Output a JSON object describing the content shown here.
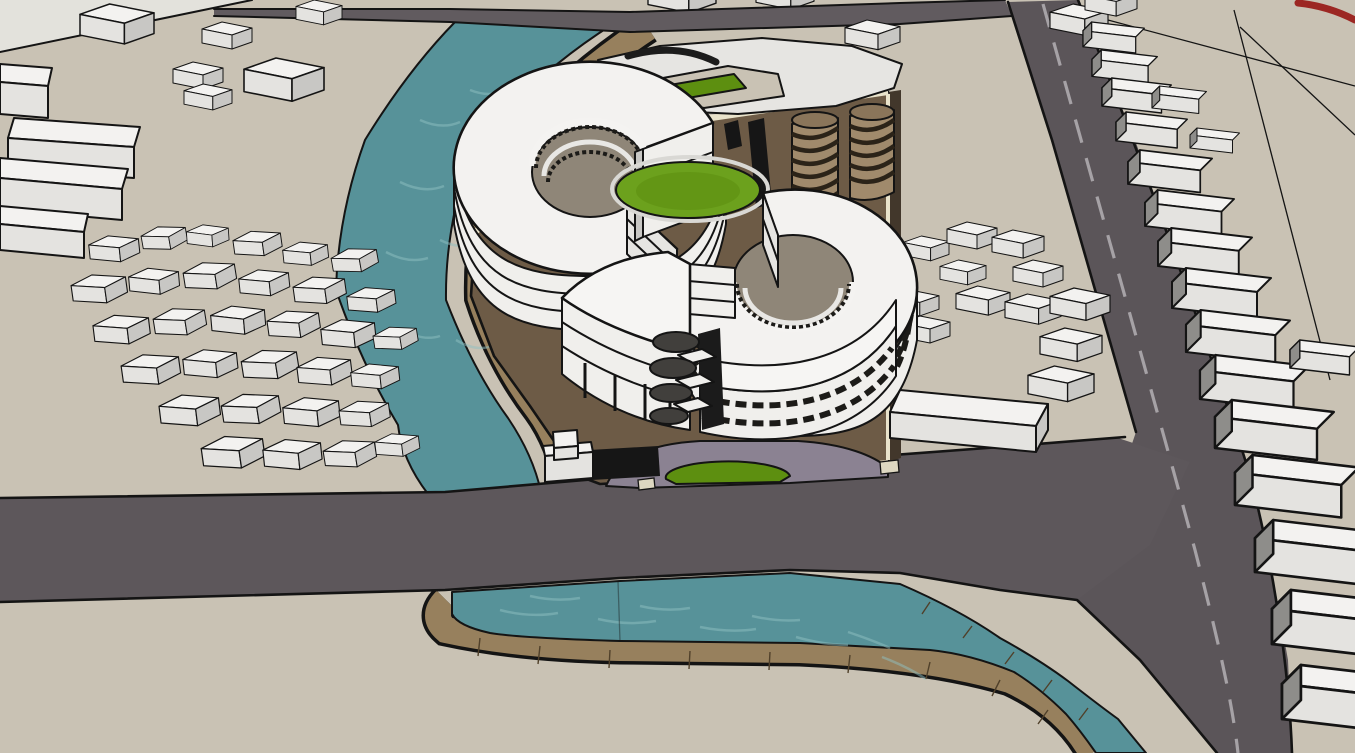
{
  "scene": {
    "title": "3D architectural site model — aerial perspective",
    "description": "SketchUp-style massing model of a riverside mixed-use development: two white circular ring buildings with inner courtyards on a brown plinth, spiral parking ramps, a curved terrace building, a teal canal with brick embankments bridged by roads, and surrounding low-rise context blocks.",
    "render_style": "sketchup-massing-model",
    "objects": [
      "ground-plane",
      "light-ground-plane",
      "canal-water",
      "canal-embankment",
      "top-road",
      "side-road",
      "main-road",
      "road-centerline-dashes",
      "site-plinth",
      "plinth-trim-band",
      "ring-building-north",
      "ring-building-south",
      "curved-terrace-building",
      "stacked-balconies",
      "central-lawn",
      "courtyard-floor",
      "spiral-ramp-1",
      "spiral-ramp-2",
      "service-column",
      "courtyard-building",
      "entry-driveway",
      "entry-lawn",
      "gate-wall",
      "stepped-kiosk",
      "low-rise-neighborhood",
      "roadside-blocks",
      "parcel-lines",
      "boundary-red-line"
    ]
  },
  "colors": {
    "ground": "#c9c2b4",
    "ground_light": "#e3e2dc",
    "road": "#5d575b",
    "road_side": "#5b5559",
    "road_top_strip": "#615b5f",
    "road_dash": "#a6a2a6",
    "water": "#579299",
    "water_highlight": "#8fc0c1",
    "embankment": "#97805d",
    "embankment_edge": "#141414",
    "plinth": "#6d5b46",
    "plinth_side": "#42372b",
    "plinth_trim": "#e9e3cb",
    "building_top": "#f3f2f0",
    "building_front": "#e4e3e0",
    "building_side": "#c8c7c4",
    "outline": "#141414",
    "grass": "#6ca11d",
    "grass_dark": "#5d8f10",
    "courtyard_floor": "#8f8678",
    "driveway": "#8b8292",
    "ramp_spiral": "#a08a6c",
    "ramp_stripe": "#2b2318",
    "black_wall": "#161616",
    "balcony": "#413f3c",
    "accent_red": "#9c2723"
  }
}
